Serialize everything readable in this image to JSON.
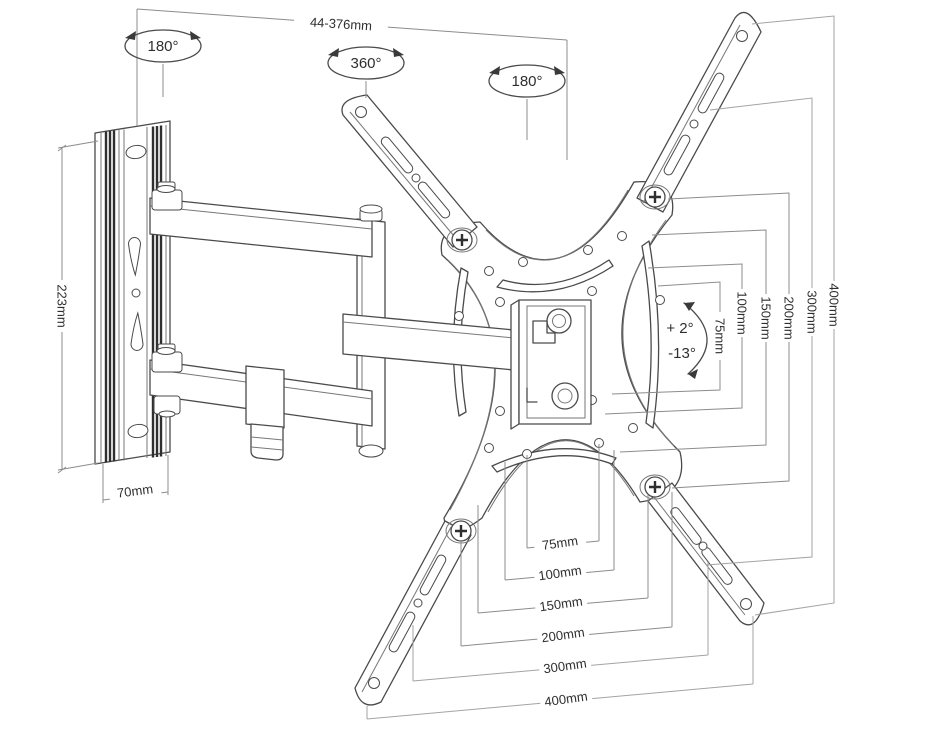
{
  "diagram": {
    "title": "TV wall mount dimensions diagram",
    "top_dimension": "44-376mm",
    "rotations": {
      "left": "180°",
      "center": "360°",
      "right": "180°"
    },
    "wall_plate": {
      "height": "223mm",
      "width": "70mm"
    },
    "tilt": {
      "up": "+ 2°",
      "down": "-13°"
    },
    "vesa_vertical": [
      "75mm",
      "100mm",
      "150mm",
      "200mm",
      "300mm",
      "400mm"
    ],
    "vesa_horizontal": [
      "75mm",
      "100mm",
      "150mm",
      "200mm",
      "300mm",
      "400mm"
    ],
    "colors": {
      "line": "#4a4a4a",
      "dimension": "#8c8c8c",
      "text": "#2f2f2f",
      "background": "#ffffff"
    }
  }
}
